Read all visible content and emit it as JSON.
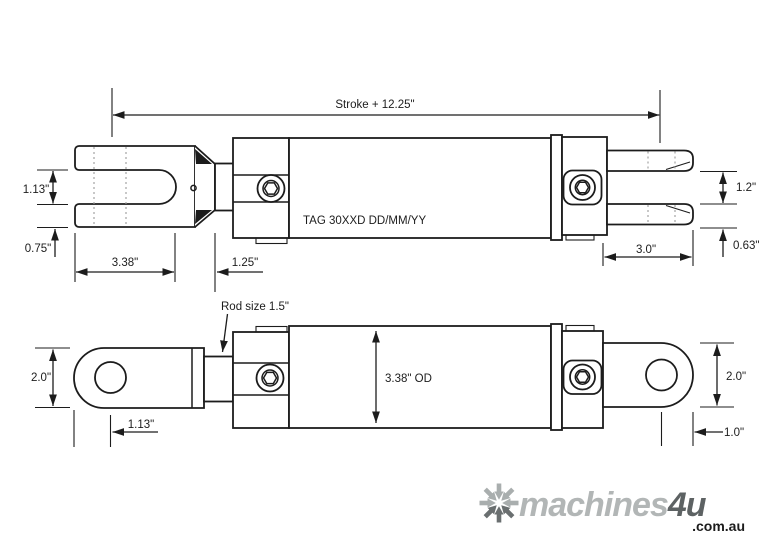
{
  "colors": {
    "line": "#1c1c1c",
    "hidden_line": "#9a9a9a",
    "background": "#ffffff",
    "logo_light": "#a9aeae",
    "logo_dark": "#5d6263"
  },
  "top_view": {
    "stroke_label": "Stroke + 12.25\"",
    "clevis_slot_width": "1.13\"",
    "clevis_tine_thickness": "0.75\"",
    "clevis_slot_depth": "3.38\"",
    "rod_clearance": "1.25\"",
    "tag_label": "TAG 30XXD DD/MM/YY",
    "prong_gap": "1.2\"",
    "prong_thickness": "0.63\"",
    "prong_length": "3.0\""
  },
  "bottom_view": {
    "rod_size_label": "Rod size 1.5\"",
    "eye_height_left": "2.0\"",
    "eye_pin_offset_left": "1.13\"",
    "barrel_od": "3.38\" OD",
    "eye_height_right": "2.0\"",
    "eye_pin_offset_right": "1.0\""
  },
  "logo": {
    "icon": "asterisk-arrows-icon",
    "name": "machines",
    "suffix": "4u",
    "tld": ".com.au"
  }
}
